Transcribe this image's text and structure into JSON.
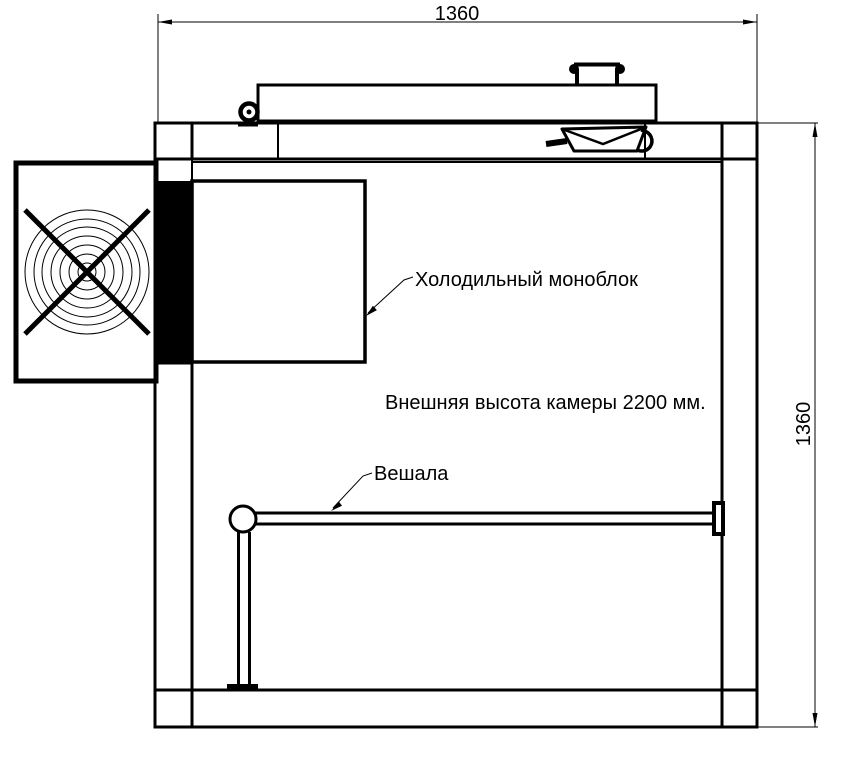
{
  "page": {
    "background_color": "#ffffff",
    "line_color": "#000000"
  },
  "dimensions": {
    "top_width": "1360",
    "right_height": "1360"
  },
  "annotations": {
    "monoblock_label": "Холодильный моноблок",
    "height_note": "Внешняя высота камеры 2200 мм.",
    "hangers_label": "Вешала"
  }
}
